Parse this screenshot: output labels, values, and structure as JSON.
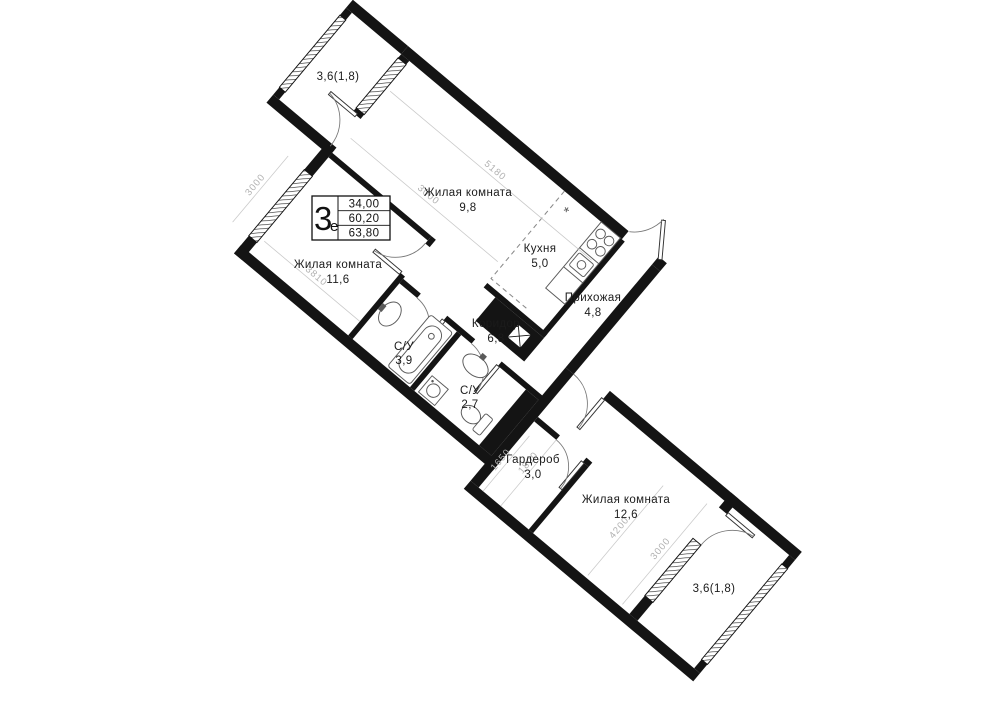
{
  "badge": {
    "type_number": "3",
    "type_suffix": "е",
    "living_area": "34,00",
    "area": "60,20",
    "total_area": "63,80"
  },
  "rooms": {
    "living1": {
      "name": "Жилая комната",
      "area": "9,8"
    },
    "kitchen": {
      "name": "Кухня",
      "area": "5,0"
    },
    "hallway": {
      "name": "Прихожая",
      "area": "4,8"
    },
    "living2": {
      "name": "Жилая комната",
      "area": "11,6"
    },
    "bath1": {
      "name": "С/У",
      "area": "3,9"
    },
    "corridor": {
      "name": "Коридор",
      "area": "6,8"
    },
    "bath2": {
      "name": "С/У",
      "area": "2,7"
    },
    "wardrobe": {
      "name": "Гардероб",
      "area": "3,0"
    },
    "living3": {
      "name": "Жилая комната",
      "area": "12,6"
    },
    "balcony_top": {
      "area": "3,6(1,8)"
    },
    "balcony_bottom": {
      "area": "3,6(1,8)"
    }
  },
  "dimensions": {
    "top_wall": "5180",
    "living1_width": "3000",
    "living2_length": "3810",
    "living2_window": "3000",
    "wardrobe_a": "1650",
    "wardrobe_b": "1800",
    "living3_length": "4200",
    "living3_width": "3000"
  },
  "icons": {
    "vent": "*"
  },
  "colors": {
    "wall": "#141414",
    "dim": "#b1b1b1",
    "label": "#1b1b1b"
  }
}
